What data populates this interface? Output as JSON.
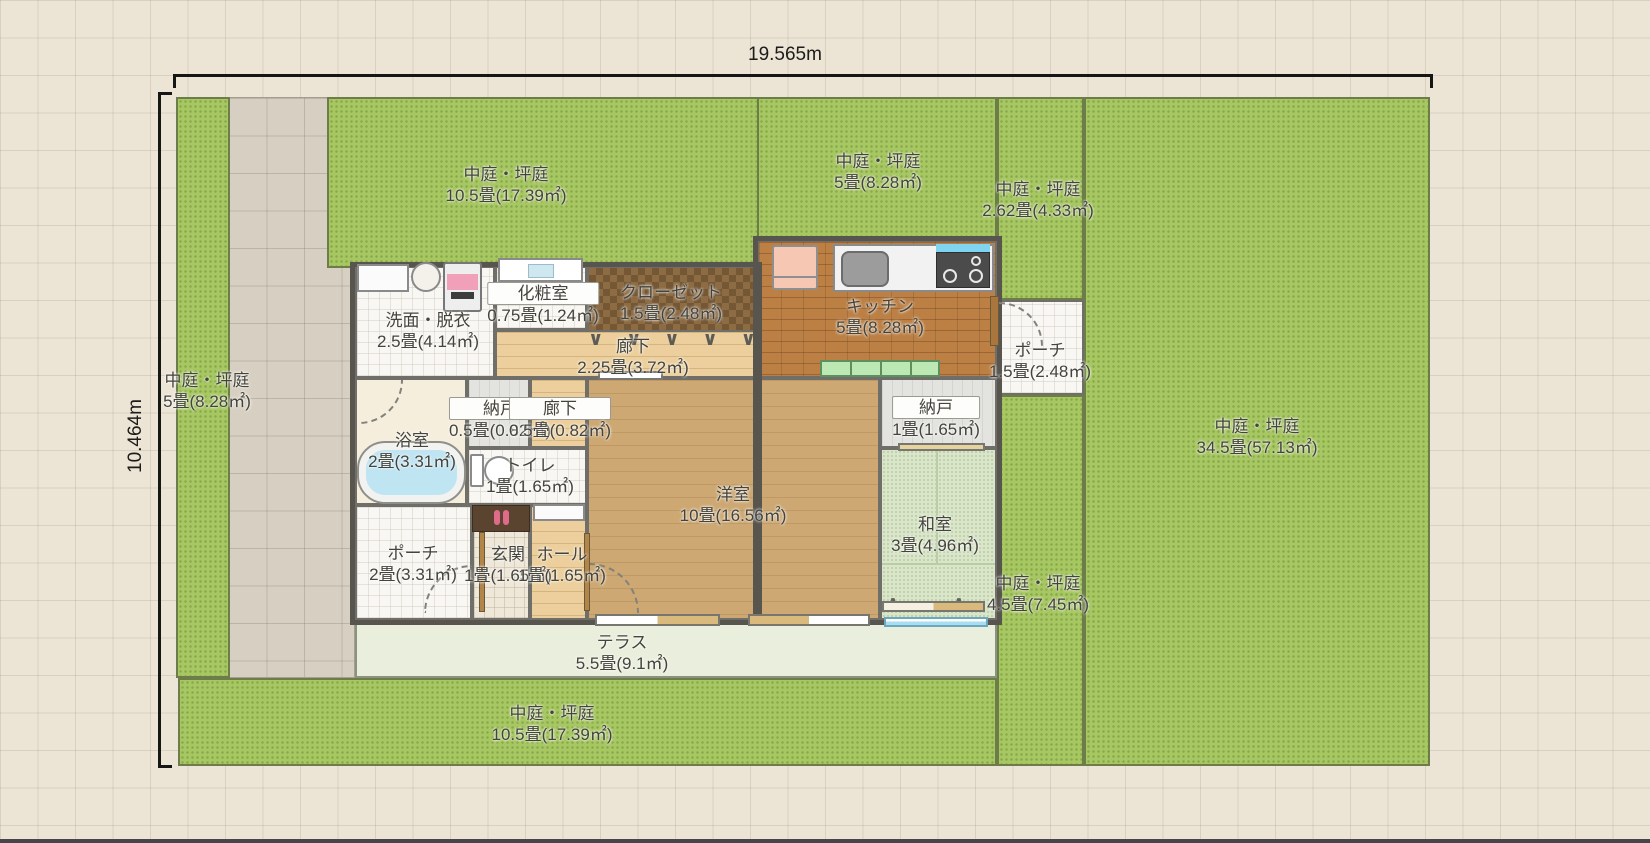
{
  "dimensions": {
    "width_label": "19.565m",
    "height_label": "10.464m"
  },
  "gardens": {
    "top_left": {
      "name": "中庭・坪庭",
      "size": "10.5畳(17.39㎡)"
    },
    "top_mid": {
      "name": "中庭・坪庭",
      "size": "5畳(8.28㎡)"
    },
    "top_right": {
      "name": "中庭・坪庭",
      "size": "2.62畳(4.33㎡)"
    },
    "left_strip": {
      "name": "中庭・坪庭",
      "size": "5畳(8.28㎡)"
    },
    "right_large": {
      "name": "中庭・坪庭",
      "size": "34.5畳(57.13㎡)"
    },
    "right_strip": {
      "name": "中庭・坪庭",
      "size": "4.5畳(7.45㎡)"
    },
    "bottom": {
      "name": "中庭・坪庭",
      "size": "10.5畳(17.39㎡)"
    }
  },
  "outdoor": {
    "terrace": {
      "name": "テラス",
      "size": "5.5畳(9.1㎡)"
    },
    "porch_entry": {
      "name": "ポーチ",
      "size": "2畳(3.31㎡)"
    },
    "porch_kitchen": {
      "name": "ポーチ",
      "size": "1.5畳(2.48㎡)"
    }
  },
  "rooms": {
    "senmen": {
      "name": "洗面・脱衣",
      "size": "2.5畳(4.14㎡)"
    },
    "kesho": {
      "name": "化粧室",
      "size": "0.75畳(1.24㎡)"
    },
    "closet": {
      "name": "クローゼット",
      "size": "1.5畳(2.48㎡)"
    },
    "hallway": {
      "name": "廊下",
      "size": "2.25畳(3.72㎡)"
    },
    "kitchen": {
      "name": "キッチン",
      "size": "5畳(8.28㎡)"
    },
    "bath": {
      "name": "浴室",
      "size": "2畳(3.31㎡)"
    },
    "nando_small": {
      "name": "納戸",
      "size": "0.5畳(0.82㎡)"
    },
    "hallway_small": {
      "name": "廊下",
      "size": "0.5畳(0.82㎡)"
    },
    "toilet": {
      "name": "トイレ",
      "size": "1畳(1.65㎡)"
    },
    "genkan": {
      "name": "玄関",
      "size": "1畳(1.65㎡)"
    },
    "hall": {
      "name": "ホール",
      "size": "1畳(1.65㎡)"
    },
    "yoshitsu": {
      "name": "洋室",
      "size": "10畳(16.56㎡)"
    },
    "nando": {
      "name": "納戸",
      "size": "1畳(1.65㎡)"
    },
    "washitsu": {
      "name": "和室",
      "size": "3畳(4.96㎡)"
    }
  },
  "icons": {
    "hanger": "∨",
    "door_peak": "∧"
  },
  "colors": {
    "garden_green": "#a6c761",
    "terrace_green": "#e9efdc",
    "tatami_green": "#d9e6c9",
    "wood_floor": "#cda873",
    "kitchen_brick": "#bc8045",
    "window_blue": "#a8dcf0",
    "fridge_pink": "#f6c8b4",
    "cabinet_green": "#bce8b4",
    "slipper_pink": "#e06a8a"
  }
}
